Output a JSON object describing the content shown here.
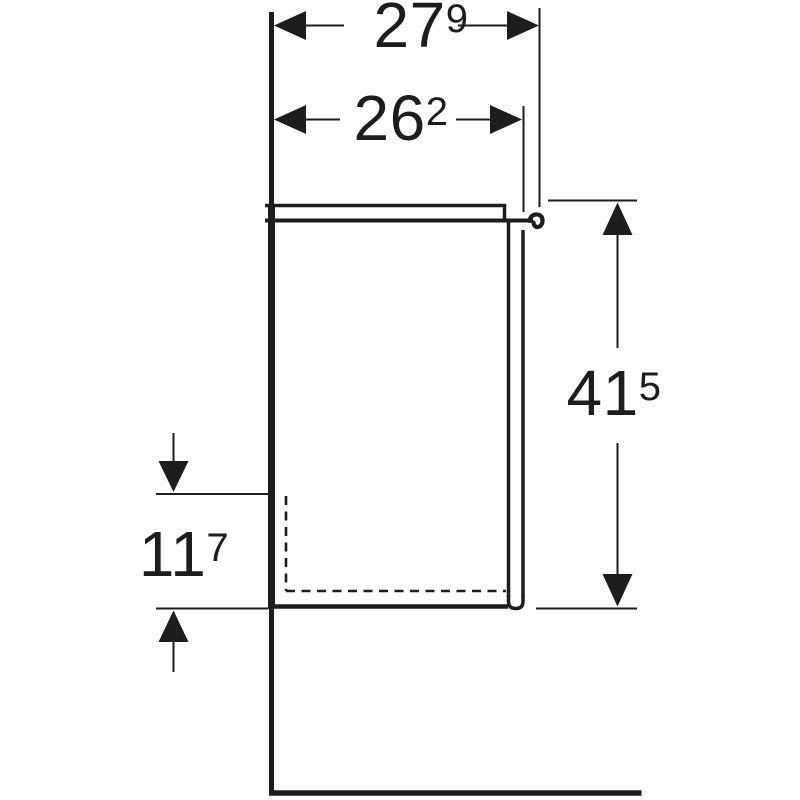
{
  "diagram": {
    "type": "technical-drawing",
    "background": "#ffffff",
    "line_color": "#1d1d1b",
    "dimensions": [
      {
        "id": "top-outer-width",
        "main": "27",
        "sup": "9"
      },
      {
        "id": "top-inner-width",
        "main": "26",
        "sup": "2"
      },
      {
        "id": "right-front-height",
        "main": "41",
        "sup": "5"
      },
      {
        "id": "left-recess-height",
        "main": "11",
        "sup": "7"
      }
    ]
  }
}
